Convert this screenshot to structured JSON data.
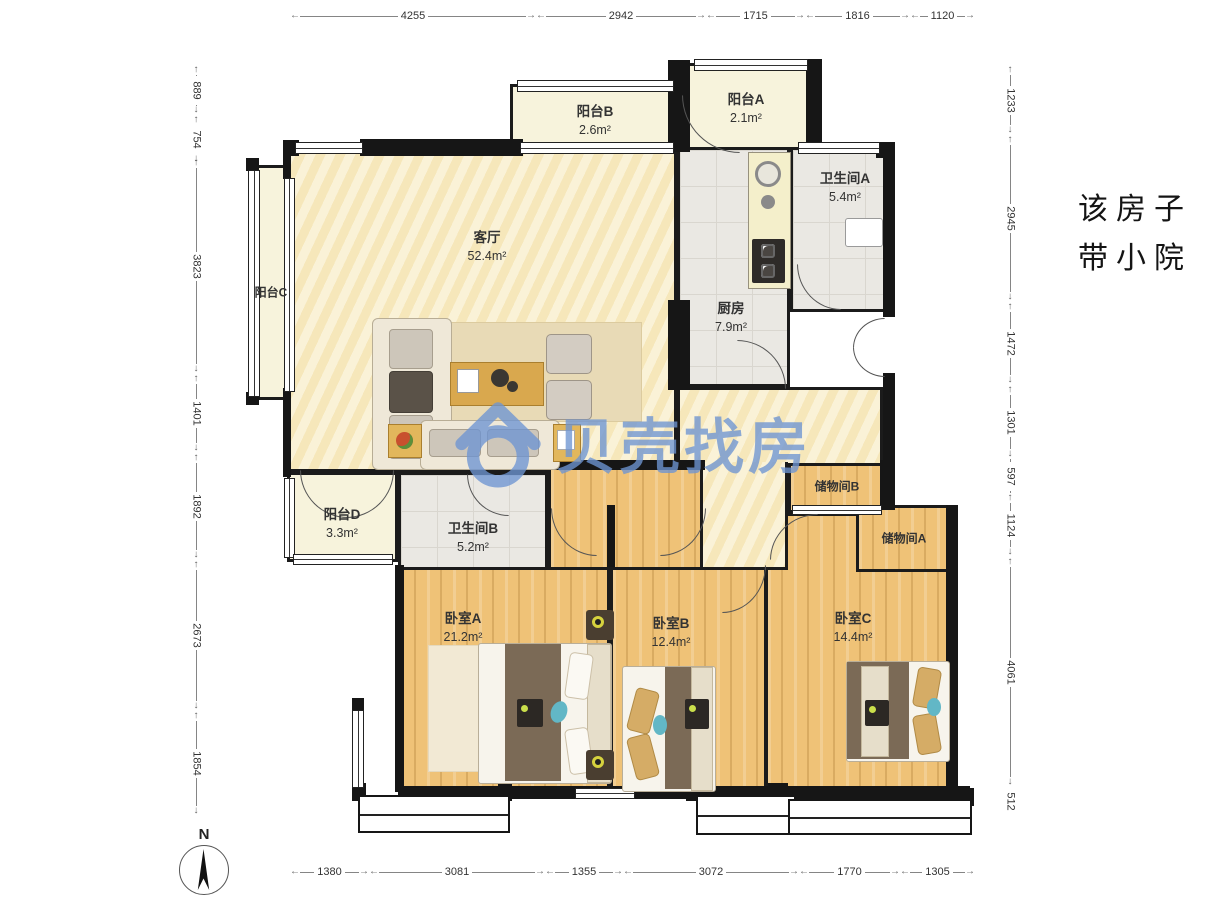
{
  "watermark": {
    "text": "贝壳找房"
  },
  "note": {
    "line1": "该房子",
    "line2": "带小院"
  },
  "compass": {
    "label": "N"
  },
  "rulers": {
    "top": [
      "4255",
      "2942",
      "1715",
      "1816",
      "1120"
    ],
    "bottom": [
      "1380",
      "3081",
      "1355",
      "3072",
      "1770",
      "1305"
    ],
    "left": [
      "889",
      "754",
      "3823",
      "1401",
      "1892",
      "2673",
      "1854"
    ],
    "right": [
      "1233",
      "2945",
      "1472",
      "1301",
      "597",
      "1124",
      "4061",
      "512"
    ]
  },
  "rooms": {
    "living": {
      "name": "客厅",
      "area": "52.4m²"
    },
    "kitchen": {
      "name": "厨房",
      "area": "7.9m²"
    },
    "bath_a": {
      "name": "卫生间A",
      "area": "5.4m²"
    },
    "bath_b": {
      "name": "卫生间B",
      "area": "5.2m²"
    },
    "balcony_a": {
      "name": "阳台A",
      "area": "2.1m²"
    },
    "balcony_b": {
      "name": "阳台B",
      "area": "2.6m²"
    },
    "balcony_c": {
      "name": "阳台C"
    },
    "balcony_d": {
      "name": "阳台D",
      "area": "3.3m²"
    },
    "storage_a": {
      "name": "储物间A"
    },
    "storage_b": {
      "name": "储物间B"
    },
    "bedroom_a": {
      "name": "卧室A",
      "area": "21.2m²"
    },
    "bedroom_b": {
      "name": "卧室B",
      "area": "12.4m²"
    },
    "bedroom_c": {
      "name": "卧室C",
      "area": "14.4m²"
    }
  },
  "colors": {
    "wall": "#161616",
    "living_floor": "#F8ECC6",
    "wood_floor": "#EFC277",
    "tile_floor": "#EAE8E3",
    "balcony_floor": "#F7F3DC",
    "watermark_blue": "#6E95D3"
  }
}
